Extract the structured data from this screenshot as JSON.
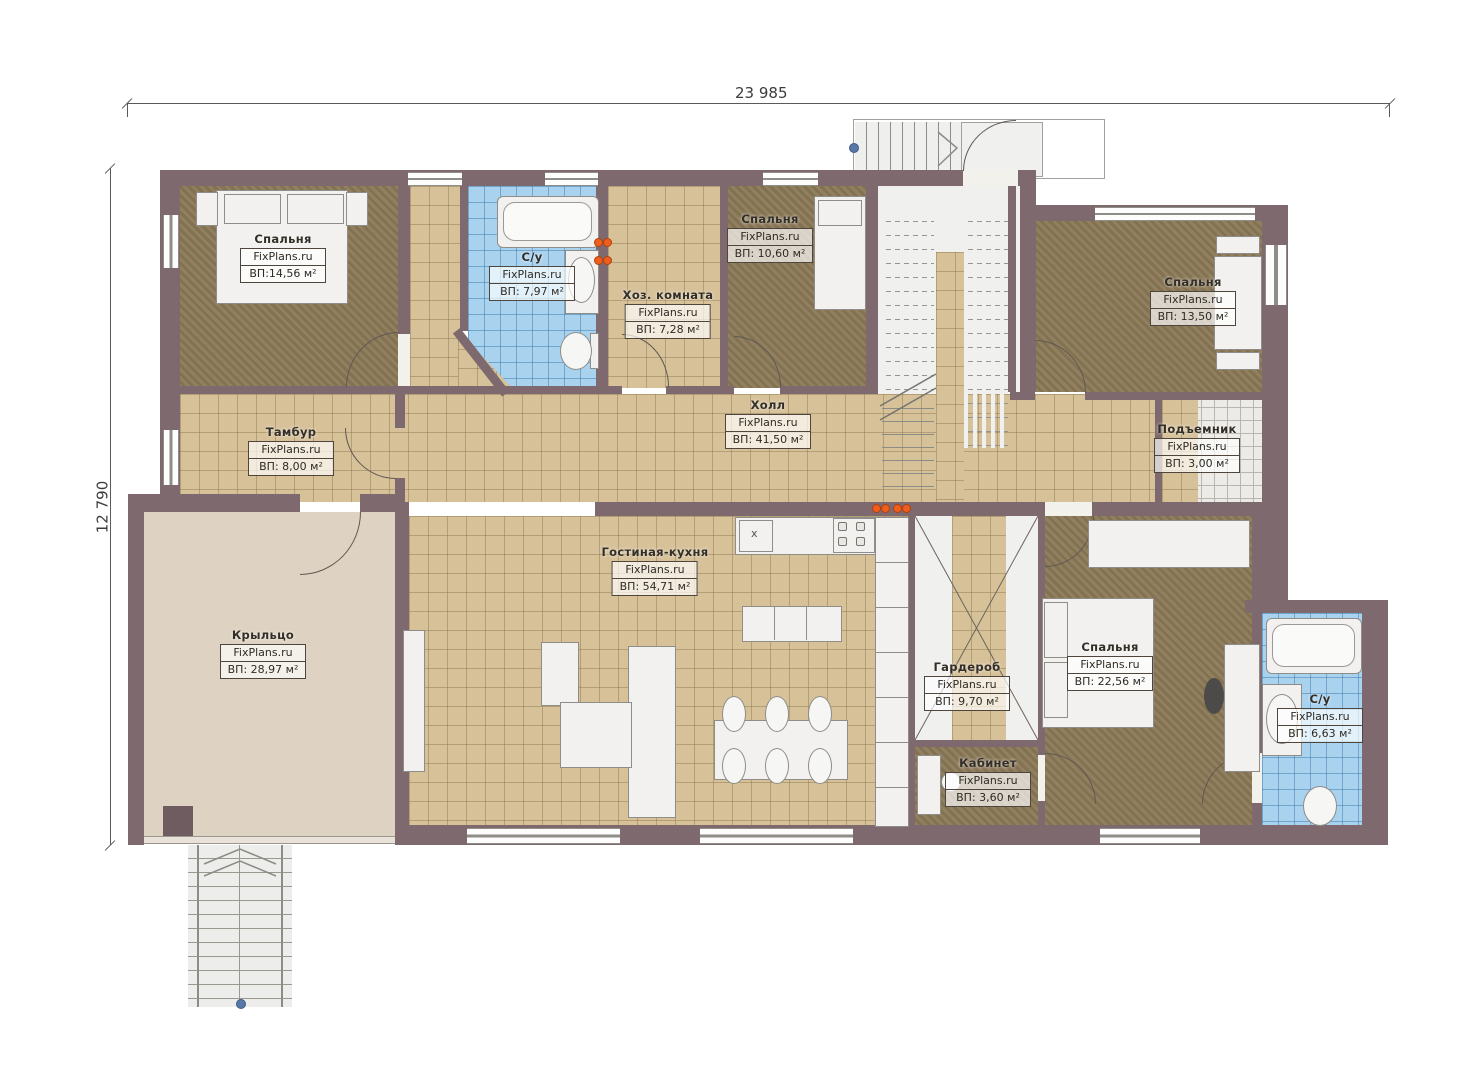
{
  "brand": "FixPlans.ru",
  "dimensions": {
    "width_label": "23 985",
    "height_label": "12 790"
  },
  "rooms": [
    {
      "name": "Спальня",
      "area": "ВП:14,56 м²"
    },
    {
      "name": "С/у",
      "area": "ВП: 7,97 м²"
    },
    {
      "name": "Хоз. комната",
      "area": "ВП: 7,28 м²"
    },
    {
      "name": "Спальня",
      "area": "ВП: 10,60 м²"
    },
    {
      "name": "Спальня",
      "area": "ВП: 13,50 м²"
    },
    {
      "name": "Тамбур",
      "area": "ВП: 8,00 м²"
    },
    {
      "name": "Холл",
      "area": "ВП: 41,50 м²"
    },
    {
      "name": "Подъемник",
      "area": "ВП: 3,00 м²"
    },
    {
      "name": "Крыльцо",
      "area": "ВП: 28,97 м²"
    },
    {
      "name": "Гостиная-кухня",
      "area": "ВП: 54,71 м²"
    },
    {
      "name": "Гардероб",
      "area": "ВП: 9,70 м²"
    },
    {
      "name": "Кабинет",
      "area": "ВП: 3,60 м²"
    },
    {
      "name": "Спальня",
      "area": "ВП: 22,56 м²"
    },
    {
      "name": "С/у",
      "area": "ВП: 6,63 м²"
    }
  ],
  "symbols": {
    "sink_marker": "х"
  }
}
